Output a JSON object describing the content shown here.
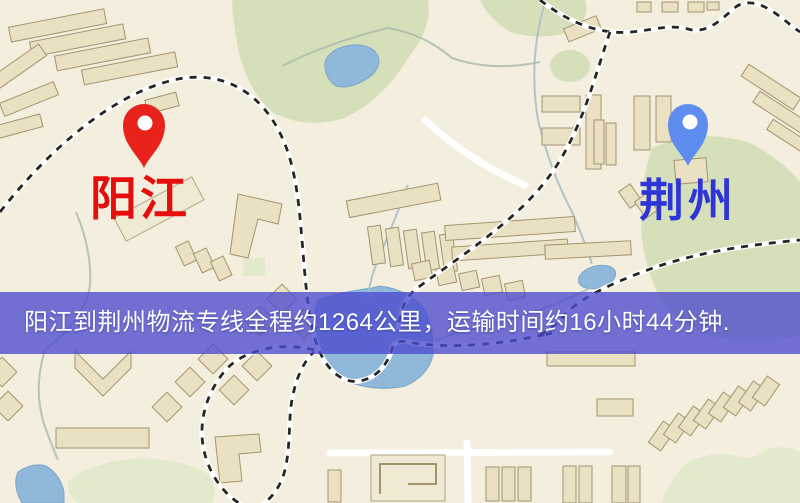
{
  "banner": {
    "text": "阳江到荆州物流专线全程约1264公里，运输时间约16小时44分钟.",
    "background_color": "#4c4bce",
    "text_color": "#ffffff"
  },
  "route": {
    "origin": "阳江",
    "destination": "荆州",
    "distance": "约1264公里",
    "duration": "约16小时44分钟"
  },
  "markers": [
    {
      "id": "origin",
      "label": "阳江",
      "pin_color": "#e8231c",
      "label_color": "#e60d0d"
    },
    {
      "id": "destination",
      "label": "荆州",
      "pin_color": "#5f8def",
      "label_color": "#2e35d6"
    }
  ],
  "map_colors": {
    "background": "#f3eede",
    "road_major": "#f3ce67",
    "road_casing": "#e0b84f",
    "building": "#eae0c2",
    "park": "#d5e0ba",
    "water": "#8fb8da",
    "railway": "#262626"
  }
}
